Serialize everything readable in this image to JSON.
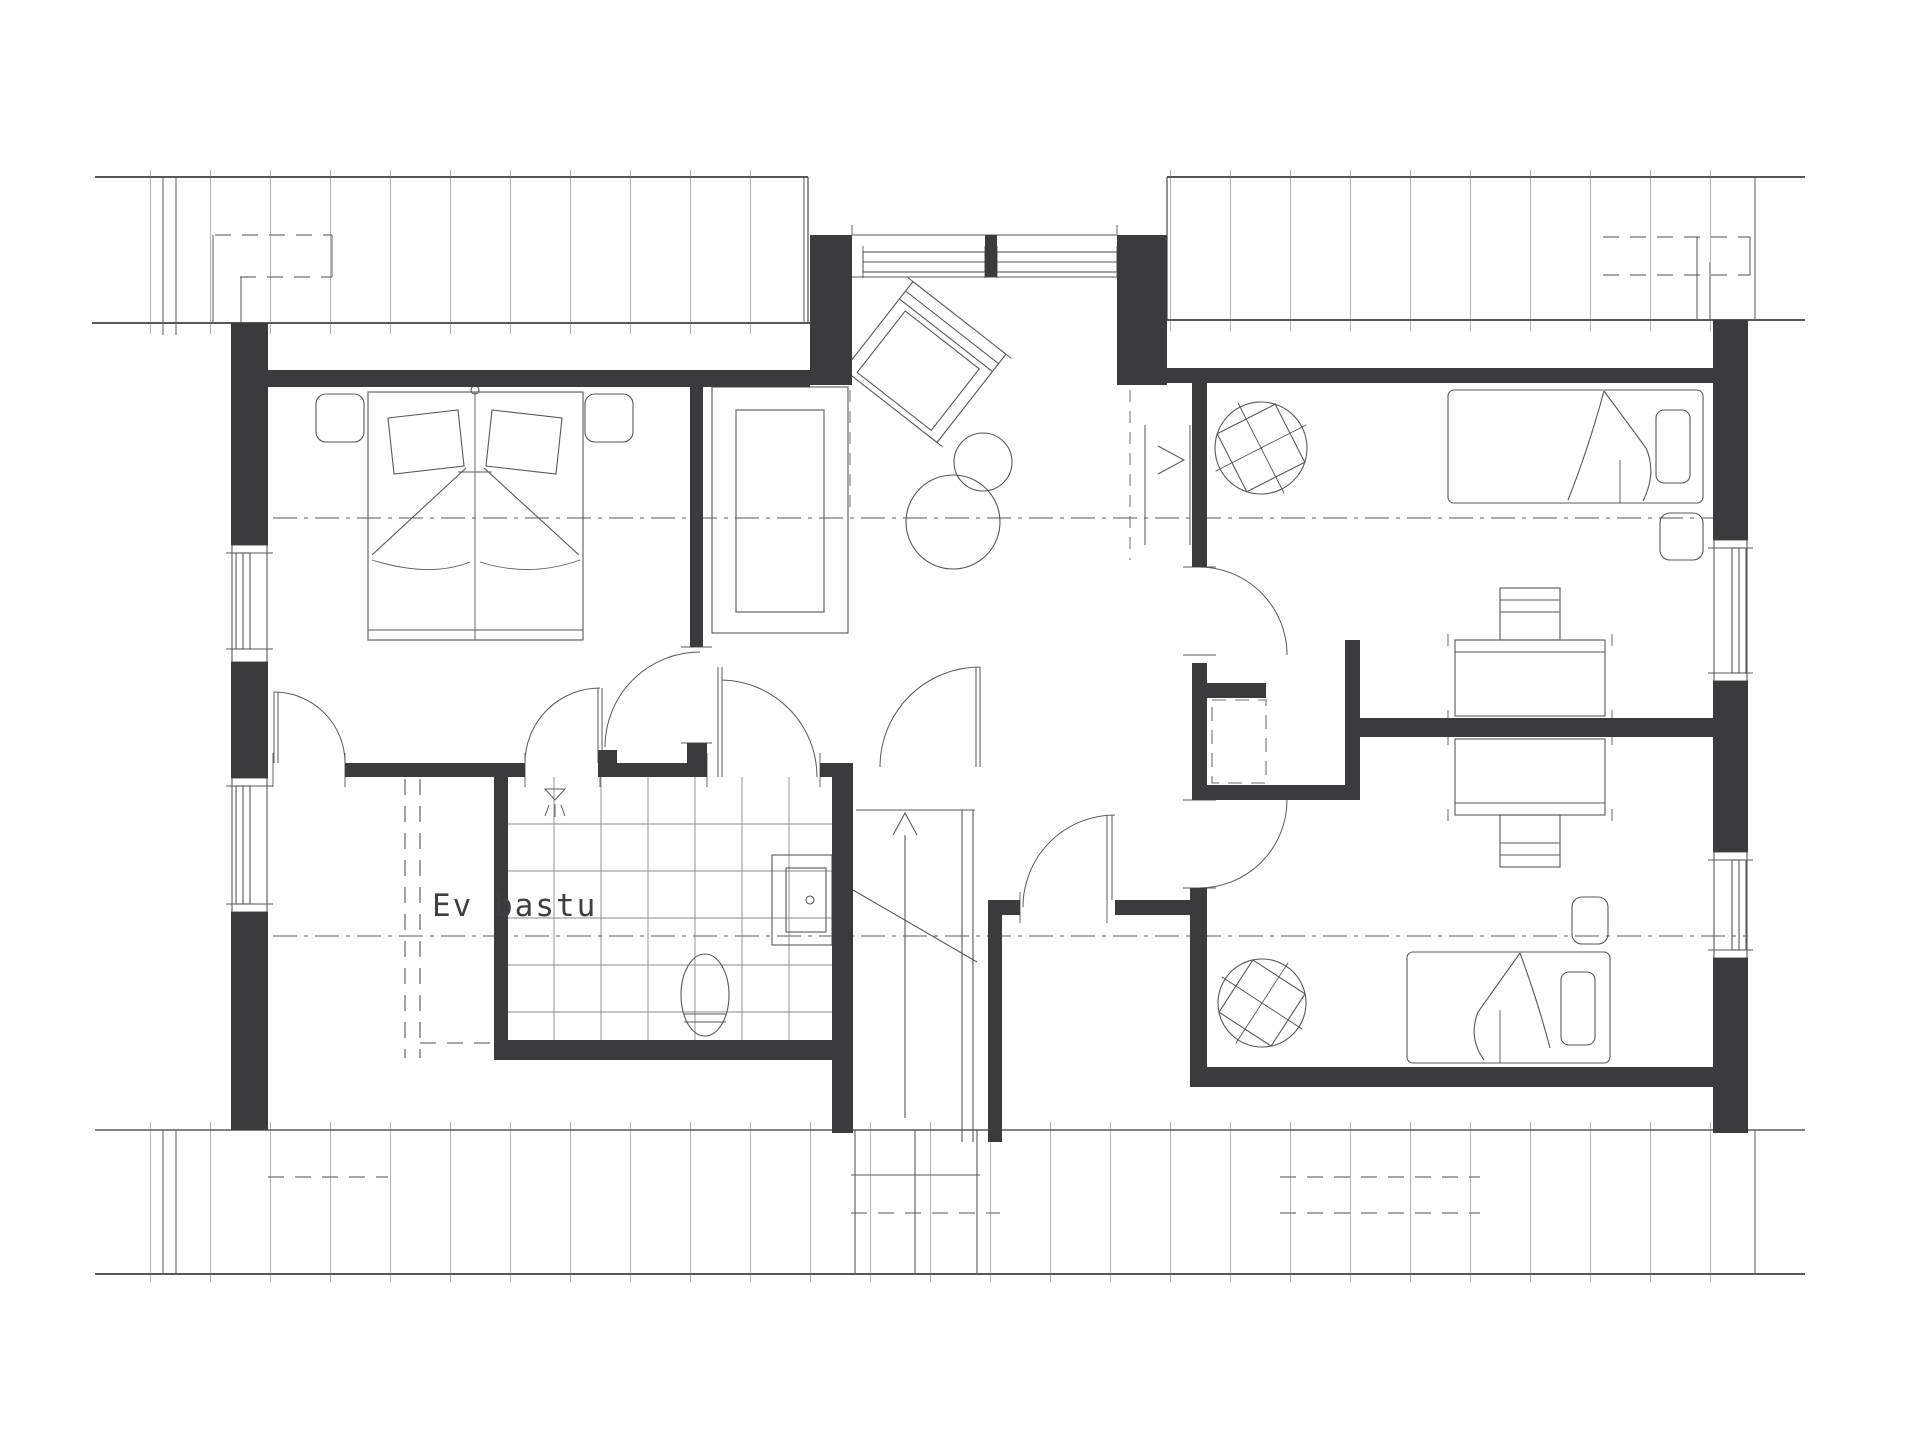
{
  "labels": {
    "ev_bastu": "Ev bastu"
  },
  "colors": {
    "wall": "#3b3b3d",
    "line": "#58585a",
    "line_light": "#8b8b8d",
    "dashed": "#6f6f71",
    "hatch": "#77777a",
    "label_text": "#3f3f41",
    "background": "#ffffff"
  }
}
